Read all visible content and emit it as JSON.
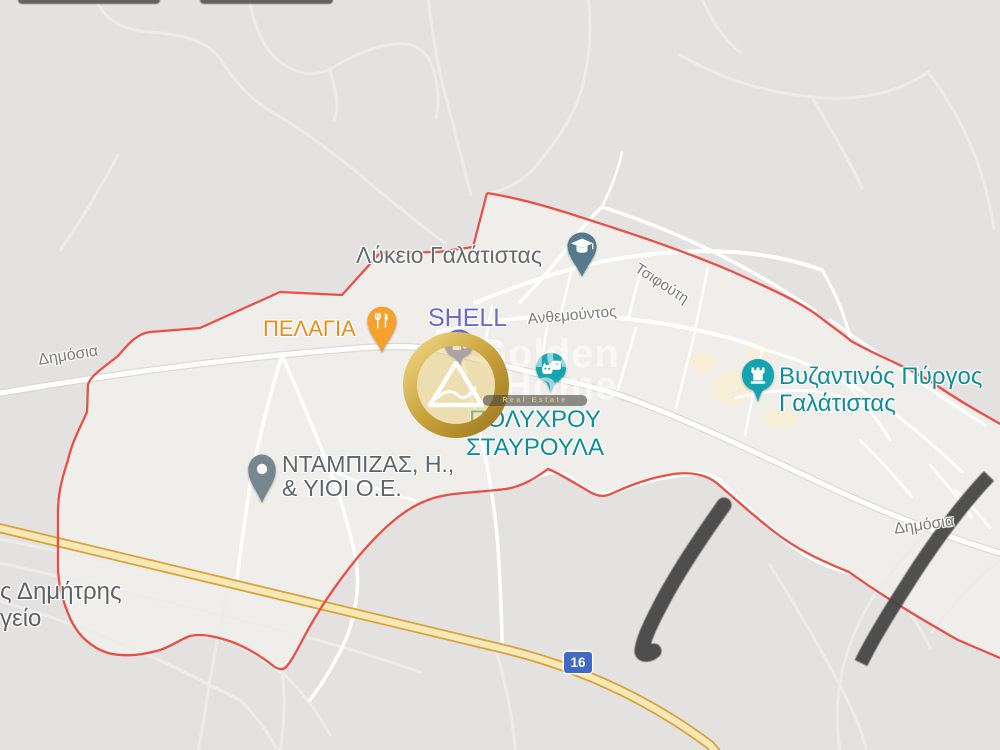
{
  "map_canvas": {
    "type": "google-map-region-view",
    "region": "Galatista"
  },
  "route_shield": {
    "number": "16",
    "color": "#3f6bc6"
  },
  "streets": {
    "tsifouti": "Τσιφούτη",
    "anthemountos": "Ανθεμούντος",
    "dimosia_left": "Δημόσια",
    "dimosia_right": "Δημόσια"
  },
  "pois": {
    "school": {
      "label": "Λύκειο Γαλάτιστας",
      "icon": "graduation-cap",
      "pin_color": "#547a8d",
      "label_color": "#66696d"
    },
    "pelagia": {
      "label": "ΠΕΛΑΓΙΑ",
      "icon": "restaurant-fork-knife",
      "pin_color": "#f5a12b",
      "label_color": "#ec8e1d"
    },
    "shell": {
      "label": "SHELL",
      "icon": "gas-pump",
      "pin_color": "#6569d6",
      "label_color": "#6d68d0"
    },
    "polychrou": {
      "label_line1": "ΠΟΛΥΧΡΟΥ",
      "label_line2": "ΣΤΑΥΡΟΥΛΑ",
      "icon": "pets",
      "pin_color": "#13a3b1",
      "label_color": "#0d8f99"
    },
    "byzantine_tower": {
      "label_line1": "Βυζαντινός Πύργος",
      "label_line2": "Γαλάτιστας",
      "icon": "castle-tower",
      "pin_color": "#13a3b1",
      "label_color": "#0d8f99"
    },
    "ntampizas": {
      "label_line1": "ΝΤΑΜΠΙΖΑΣ, Η.,",
      "label_line2": "& ΥΙΟΙ Ο.Ε.",
      "icon": "generic-dot",
      "pin_color": "#76878f",
      "label_color": "#5b656c"
    },
    "dimitris": {
      "label_line1": "ς Δημήτρης",
      "label_line2": "γείο",
      "label_color": "#5e6267"
    }
  },
  "watermark": {
    "brand_line1": "Golden",
    "brand_line2": "Home",
    "tagline": "Real Estate",
    "gold": "#c9a23a"
  },
  "boundary": {
    "color": "#e8483e"
  },
  "colors": {
    "inside_area": "#efeeeb",
    "outside_area": "#e3e2e0",
    "road": "#ffffff",
    "highway_fill": "#f8e8b5",
    "highway_casing": "#d8a23c",
    "annotation_stroke": "#3d3d3d",
    "teal_poi": "#0d8f99",
    "street_label": "#7b7b7b"
  }
}
